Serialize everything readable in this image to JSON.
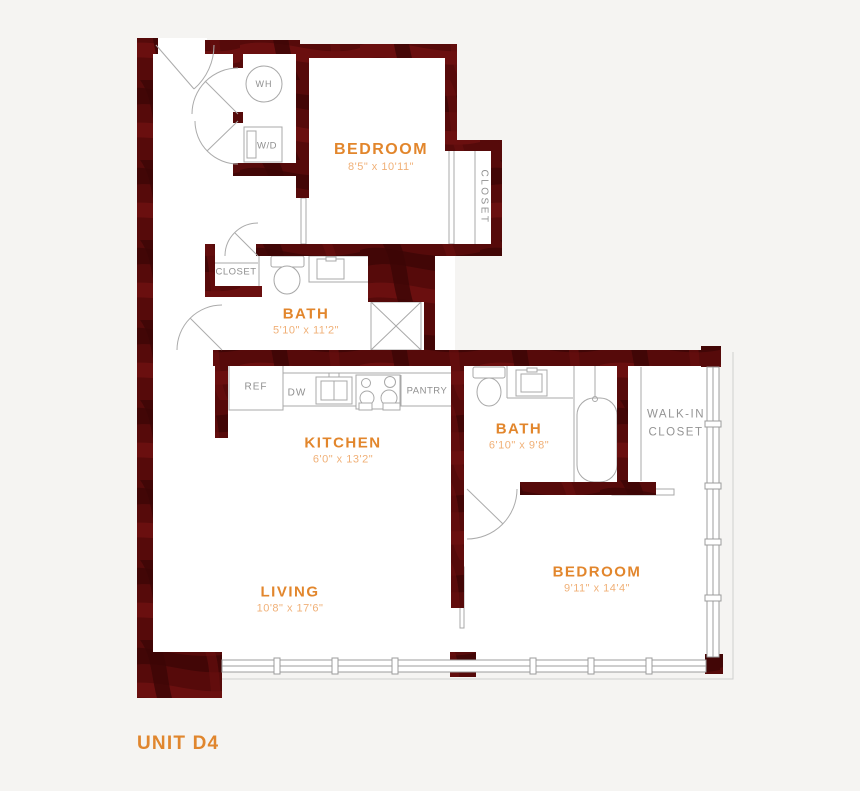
{
  "unit": {
    "label": "UNIT D4"
  },
  "colors": {
    "wall": "#560A0A",
    "wall_dark": "#420606",
    "wall_light": "#6D1111",
    "accent": "#E2862C",
    "dim_text": "#F0B077",
    "fixture_line": "#A8A8A8",
    "label_gray": "#8F8F8F",
    "background": "#F5F4F2",
    "floor": "#FFFFFF"
  },
  "rooms": [
    {
      "id": "bedroom-1",
      "name": "BEDROOM",
      "dims": "8'5\" x 10'11\""
    },
    {
      "id": "bath-1",
      "name": "BATH",
      "dims": "5'10\" x 11'2\""
    },
    {
      "id": "kitchen",
      "name": "KITCHEN",
      "dims": "6'0\" x 13'2\""
    },
    {
      "id": "bath-2",
      "name": "BATH",
      "dims": "6'10\" x 9'8\""
    },
    {
      "id": "bedroom-2",
      "name": "BEDROOM",
      "dims": "9'11\" x 14'4\""
    },
    {
      "id": "living",
      "name": "LIVING",
      "dims": "10'8\" x 17'6\""
    }
  ],
  "fixtures": {
    "wh": "WH",
    "wd": "W/D",
    "ref": "REF",
    "dw": "DW",
    "pantry": "PANTRY",
    "closet_bedroom": "CLOSET",
    "closet_hall": "CLOSET",
    "walk_in_1": "WALK-IN",
    "walk_in_2": "CLOSET"
  }
}
